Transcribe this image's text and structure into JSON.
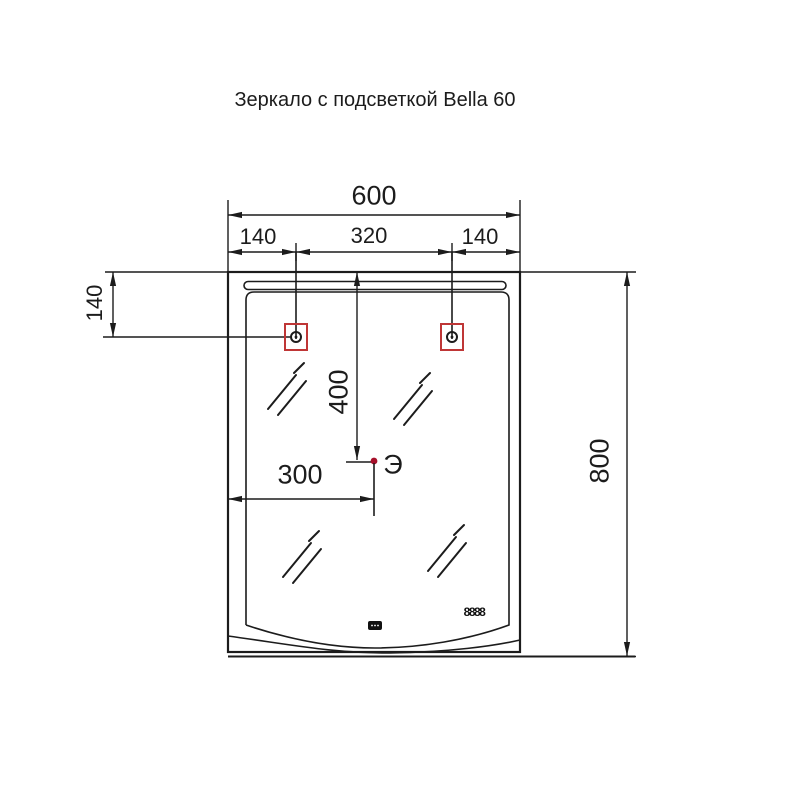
{
  "title": "Зеркало с подсветкой Bella 60",
  "dims": {
    "total_width": "600",
    "mount_left_offset": "140",
    "mount_span": "320",
    "mount_right_offset": "140",
    "mount_top_offset": "140",
    "power_from_top": "400",
    "power_from_left": "300",
    "total_height": "800"
  },
  "labels": {
    "power_point": "Э",
    "clock_display": "8888"
  },
  "icons": {
    "mount_point": "mount-point-icon",
    "mirror_shine": "mirror-shine-icon",
    "touch_sensor": "touch-sensor-icon",
    "power_dot": "power-dot-icon"
  },
  "colors": {
    "line": "#1c1c1c",
    "accent_red": "#bf3636",
    "power_dot_red": "#a6102a",
    "background": "#ffffff"
  }
}
